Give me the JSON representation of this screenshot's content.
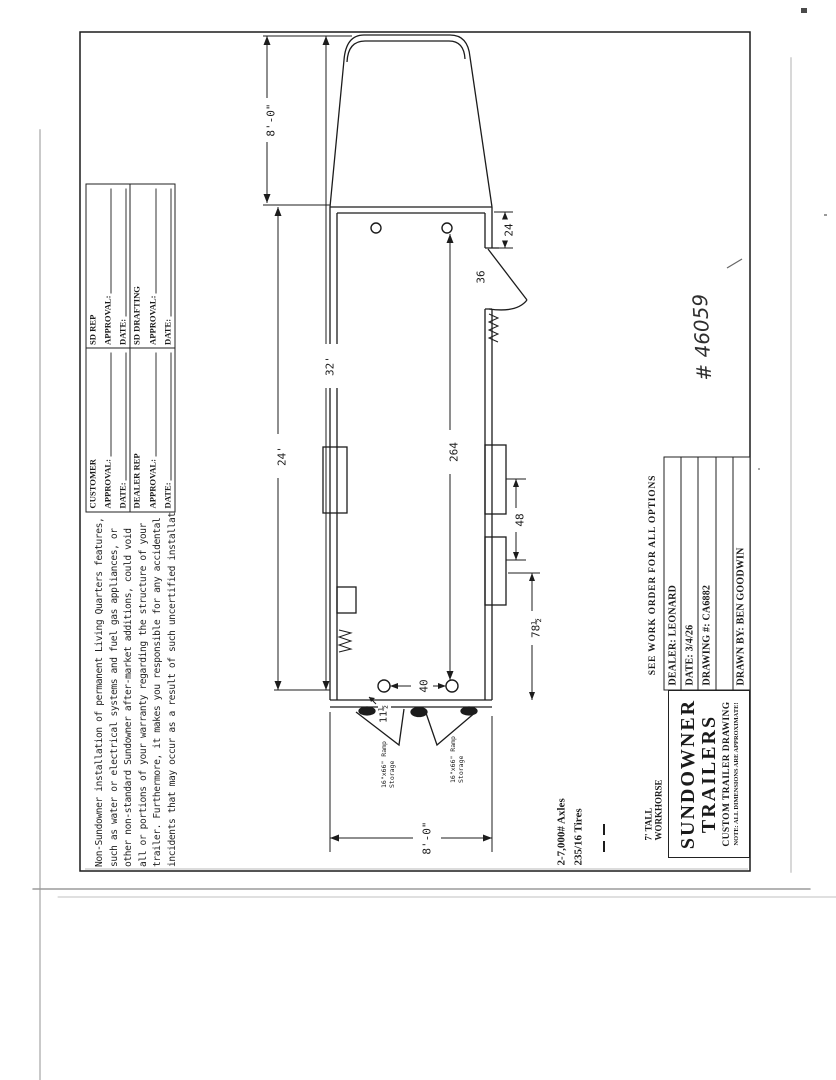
{
  "colors": {
    "ink": "#1c1c1c",
    "paper": "#ffffff"
  },
  "sheet": {
    "handwritten_number": "# 46059"
  },
  "disclaimer": {
    "lines": [
      "Non-Sundowner installation of permanent Living Quarters features,",
      "such as water or electrical systems and fuel gas appliances, or",
      "other non-standard Sundowner after-market additions, could void",
      "all or portions of your warranty regarding the structure of your",
      "trailer. Furthermore, it makes you responsible for any accidental",
      "incidents that may occur as a result of such uncertified installations."
    ]
  },
  "approvals": {
    "cells": [
      {
        "org": "CUSTOMER",
        "approval_label": "APPROVAL:",
        "date_label": "DATE:"
      },
      {
        "org": "SD REP",
        "approval_label": "APPROVAL:",
        "date_label": "DATE:"
      },
      {
        "org": "DEALER REP",
        "approval_label": "APPROVAL:",
        "date_label": "DATE:"
      },
      {
        "org": "SD DRAFTING",
        "approval_label": "APPROVAL:",
        "date_label": "DATE:"
      }
    ]
  },
  "title_block": {
    "see_work_order": "SEE WORK ORDER FOR ALL OPTIONS",
    "dealer": "DEALER: LEONARD",
    "date": "DATE: 3/4/26",
    "drawing_no": "DRAWING #: CA6882",
    "drawn_by": "DRAWN BY: BEN GOODWIN",
    "company_line1": "SUNDOWNER",
    "company_line2": "TRAILERS",
    "subtitle": "CUSTOM TRAILER DRAWING",
    "note": "NOTE: ALL DIMENSIONS ARE APPROXIMATE!"
  },
  "notes": {
    "height": "7' TALL",
    "model": "WORKHORSE",
    "axles": "2-7,000# Axles",
    "tires": "235/16 Tires"
  },
  "dimensions": {
    "gooseneck_length": "8'-0\"",
    "overall_length": "32'",
    "box_length": "24'",
    "interior_length": "264",
    "door_offset": "24",
    "door_width": "36",
    "window_spacing": "48",
    "rear_section": "78½",
    "ring_spacing": "40",
    "ring_offset": "11½",
    "rear_width": "8'-0\""
  },
  "ramp": {
    "size": "16\"x66\" Ramp",
    "storage": "Storage"
  }
}
